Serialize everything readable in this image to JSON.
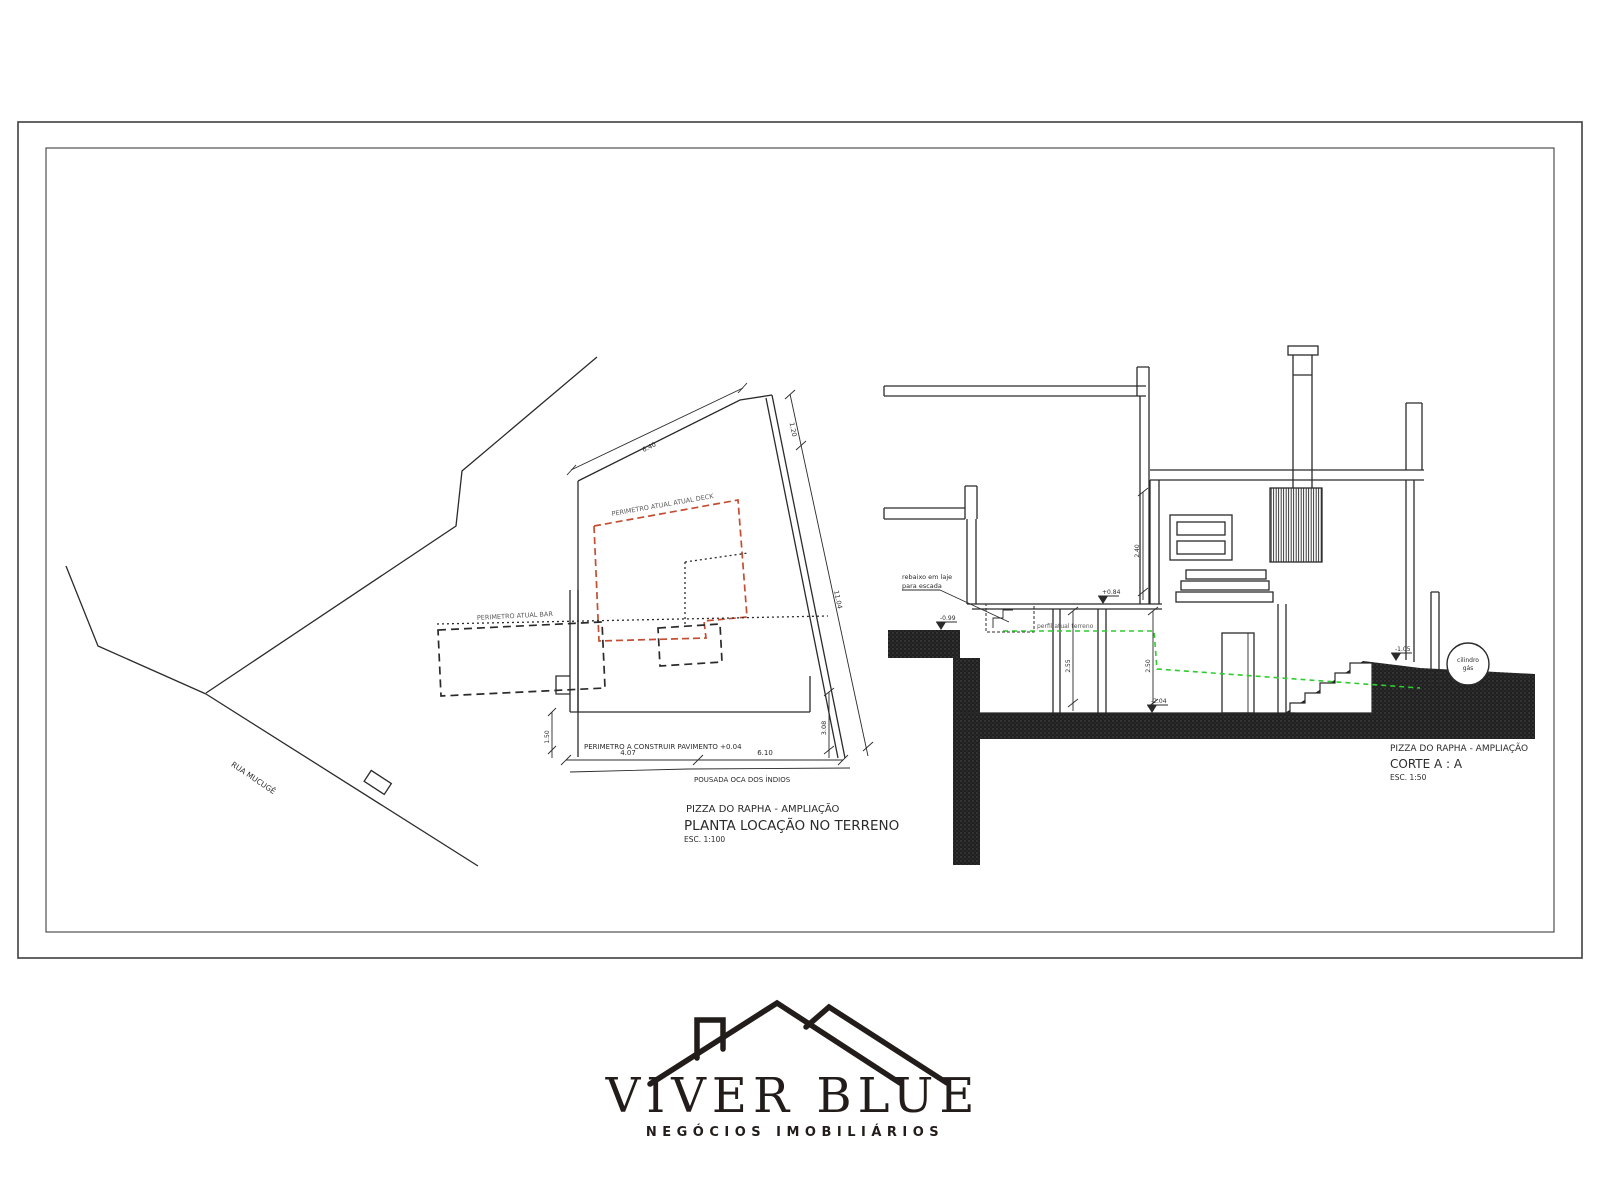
{
  "plan": {
    "title": "PIZZA DO RAPHA - AMPLIAÇÃO",
    "subtitle": "PLANTA LOCAÇÃO NO TERRENO",
    "scale": "ESC. 1:100",
    "label_deck": "PERIMETRO ATUAL ATUAL DECK",
    "label_bar": "PERIMETRO ATUAL BAR",
    "label_build": "PERIMETRO A CONSTRUIR PAVIMENTO +0.04",
    "label_street": "RUA MUCUGÊ",
    "label_neighbor": "POUSADA OCA DOS ÍNDIOS",
    "dim_top": "6.40",
    "dim_right_upper": "1.20",
    "dim_right_slope": "11.04",
    "dim_right_lower": "3.08",
    "dim_bottom_left": "4.07",
    "dim_bottom_right": "6.10",
    "dim_left": "1.50"
  },
  "section": {
    "title": "PIZZA DO RAPHA - AMPLIAÇÃO",
    "subtitle": "CORTE A : A",
    "scale": "ESC. 1:50",
    "label_recess_1": "rebaixo em laje",
    "label_recess_2": "para escada",
    "label_terrain": "perfil atual terreno",
    "label_gas_1": "cilindro",
    "label_gas_2": "gás",
    "level_ground_left": "-0.99",
    "level_deck": "+0.84",
    "level_floor": "-2.04",
    "level_yard": "-1.05",
    "dim_upper": "2.40",
    "dim_lower_left": "2.55",
    "dim_lower_right": "2.50"
  },
  "logo": {
    "name": "VIVER BLUE",
    "tagline": "NEGÓCIOS IMOBILIÁRIOS"
  }
}
